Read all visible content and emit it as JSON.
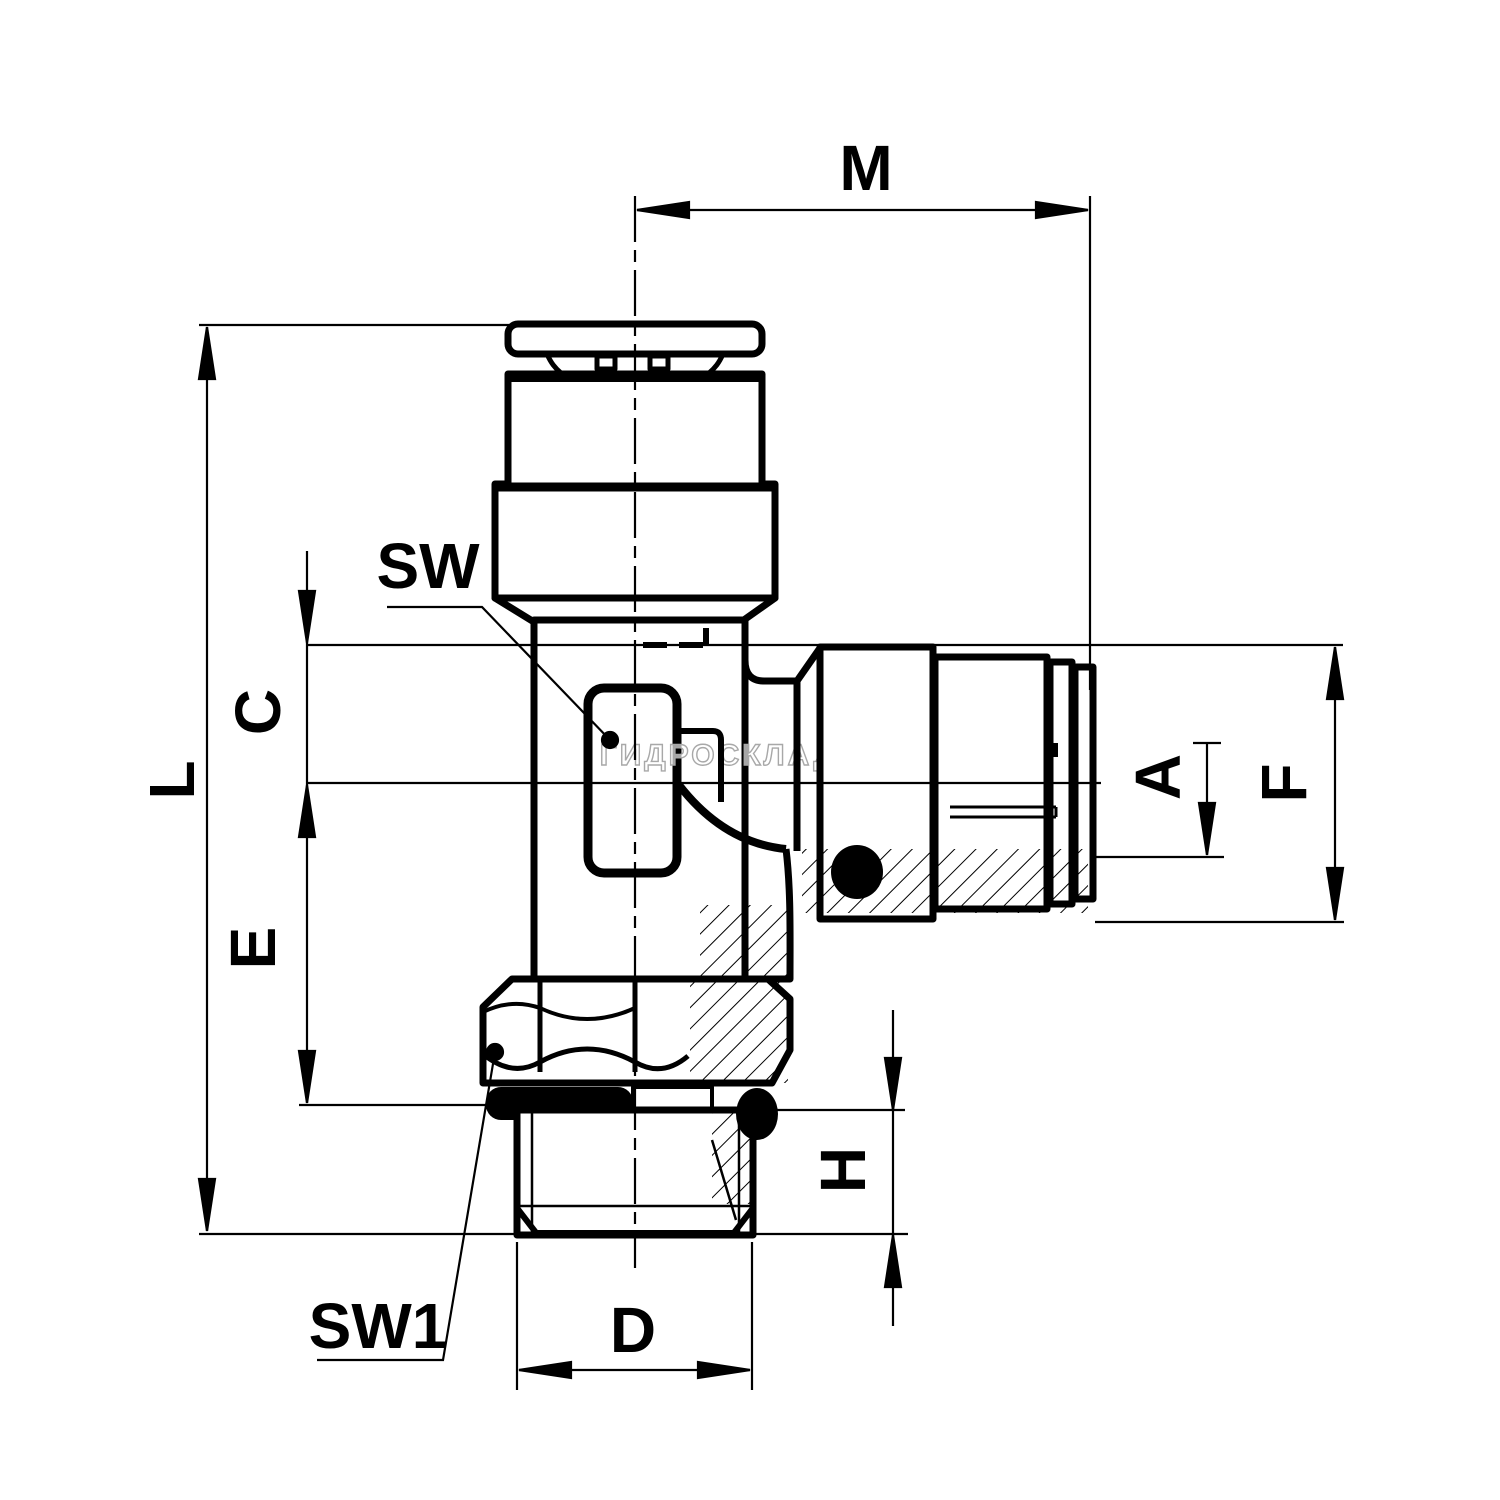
{
  "page": {
    "background": "#ffffff",
    "line_color": "#000000",
    "watermark_color": "#a8a8a8"
  },
  "drawing": {
    "kind": "technical-drawing",
    "subject": "push-in banjo tee fitting cross-section"
  },
  "labels": {
    "m": "M",
    "l": "L",
    "c": "C",
    "e": "E",
    "f": "F",
    "a": "A",
    "h": "H",
    "d": "D",
    "sw": "SW",
    "sw1": "SW1"
  },
  "watermark": {
    "text": "ГИДРОСКЛАД.РФ"
  }
}
